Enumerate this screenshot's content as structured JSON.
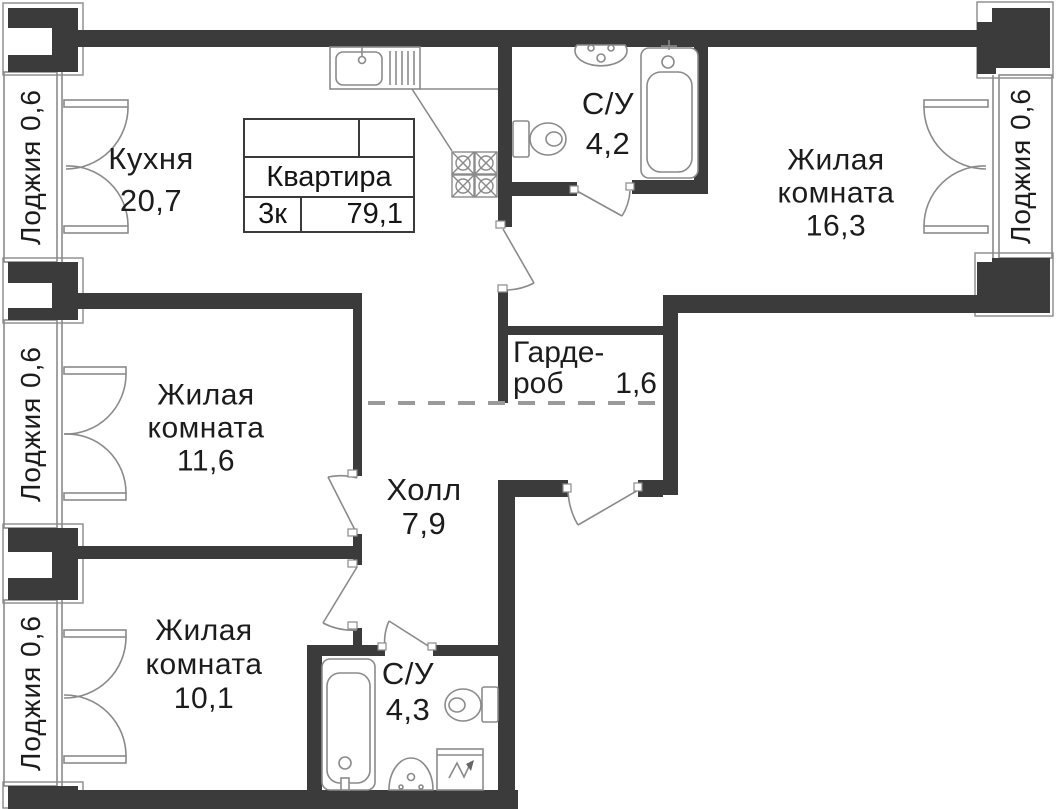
{
  "plan": {
    "info_table": {
      "title": "Квартира",
      "rooms_label": "3к",
      "total_area": "79,1"
    },
    "rooms": {
      "kitchen": {
        "name": "Кухня",
        "area": "20,7"
      },
      "bathroom_top": {
        "name": "С/У",
        "area": "4,2"
      },
      "living_right": {
        "l1": "Жилая",
        "l2": "комната",
        "area": "16,3"
      },
      "wardrobe": {
        "l1": "Гарде-",
        "l2": "роб",
        "area": "1,6"
      },
      "living_middle": {
        "l1": "Жилая",
        "l2": "комната",
        "area": "11,6"
      },
      "hall": {
        "name": "Холл",
        "area": "7,9"
      },
      "living_bottom": {
        "l1": "Жилая",
        "l2": "комната",
        "area": "10,1"
      },
      "bathroom_bottom": {
        "name": "С/У",
        "area": "4,3"
      }
    },
    "loggias": [
      {
        "label": "Лоджия 0,6"
      },
      {
        "label": "Лоджия 0,6"
      },
      {
        "label": "Лоджия 0,6"
      },
      {
        "label": "Лоджия 0,6"
      }
    ],
    "colors": {
      "wall": "#3b3b3b",
      "line": "#8a8a8a",
      "text": "#1c1c1c",
      "dashed": "#9a9a9a"
    }
  }
}
